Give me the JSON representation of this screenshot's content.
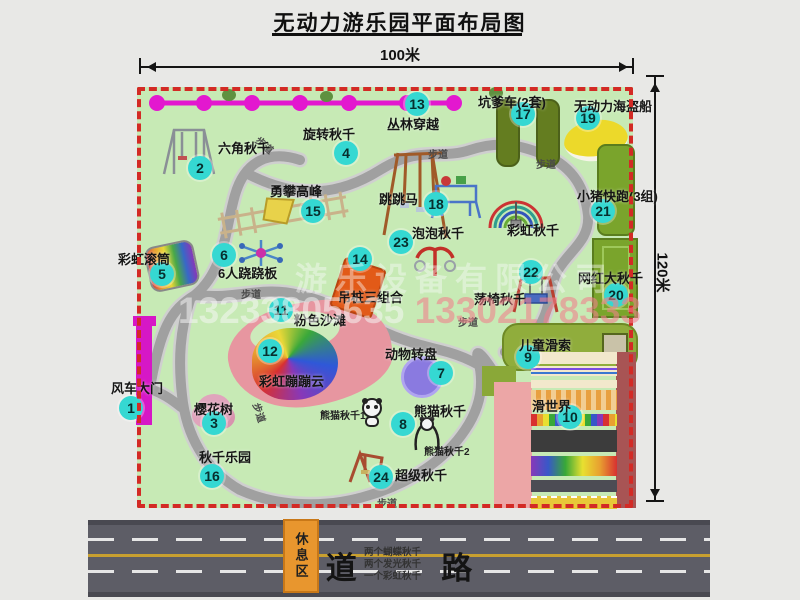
{
  "title": "无动力游乐园平面布局图",
  "dim_top": "100米",
  "dim_right": "120米",
  "road_label": "道 路",
  "footpath": "步道",
  "rest_area": "休息区",
  "rainbow_swing_label": "彩虹秋千",
  "panda1": "熊猫秋千1",
  "panda2": "熊猫秋千2",
  "watermark": {
    "company": "游乐设备有限公司",
    "phone1": "13233805635",
    "phone2": "13302178333"
  },
  "swing_notes": [
    "两个蝴蝶秋千",
    "两个发光秋千",
    "一个彩虹秋千"
  ],
  "attractions": [
    {
      "id": "1",
      "label": "风车大门"
    },
    {
      "id": "2",
      "label": "六角秋千"
    },
    {
      "id": "3",
      "label": "樱花树"
    },
    {
      "id": "4",
      "label": "旋转秋千"
    },
    {
      "id": "5",
      "label": "彩虹滚筒"
    },
    {
      "id": "6",
      "label": "6人跷跷板"
    },
    {
      "id": "7",
      "label": "动物转盘"
    },
    {
      "id": "8",
      "label": "熊猫秋千"
    },
    {
      "id": "9",
      "label": "儿童滑索"
    },
    {
      "id": "10",
      "label": "滑世界"
    },
    {
      "id": "11",
      "label": "粉色沙滩"
    },
    {
      "id": "12",
      "label": "彩虹蹦蹦云"
    },
    {
      "id": "13",
      "label": "丛林穿越"
    },
    {
      "id": "14",
      "label": "吊桩三组合"
    },
    {
      "id": "15",
      "label": "勇攀高峰"
    },
    {
      "id": "16",
      "label": "秋千乐园"
    },
    {
      "id": "17",
      "label": "坑爹车(2套)"
    },
    {
      "id": "18",
      "label": "跳跳马"
    },
    {
      "id": "19",
      "label": "无动力海盗船"
    },
    {
      "id": "20",
      "label": "网红大秋千"
    },
    {
      "id": "21",
      "label": "小猪快跑(3组)"
    },
    {
      "id": "22",
      "label": "荡椅秋千"
    },
    {
      "id": "23",
      "label": "泡泡秋千"
    },
    {
      "id": "24",
      "label": "超级秋千"
    }
  ],
  "colors": {
    "badge": "#35d8d2",
    "magenta": "#e318cf",
    "map_green": "#c7eab5",
    "border_red": "#d32a25",
    "road_gray": "#5d5d66"
  }
}
